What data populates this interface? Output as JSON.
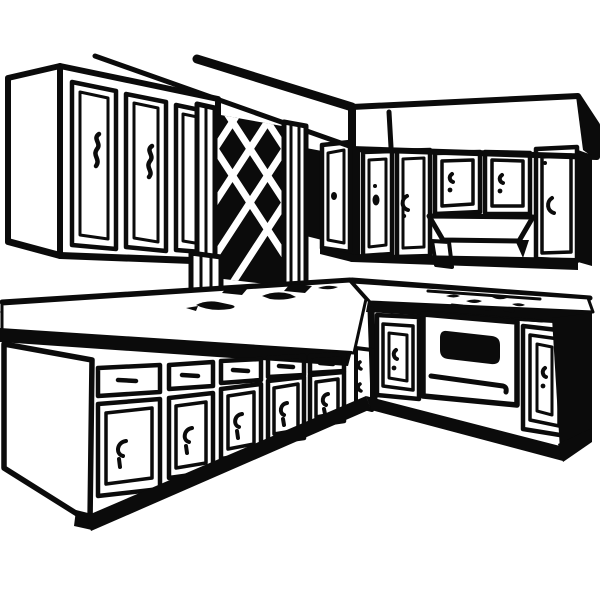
{
  "meta": {
    "title": "Retro kitchen clipart",
    "description": "Black-and-white vintage line-art clipart of an L-shaped kitchen: upper wall cabinets on the left, a dark lattice window between pillars, a soffit with upper cabinets and a range hood on the right wall, an L-shaped countertop with sink shadows and cooktop burner marks, base cabinets with drawers and panel doors, and an oven with a dark window on the right run."
  },
  "colors": {
    "ink": "#0b0b0b",
    "background": "#ffffff"
  },
  "scene": {
    "style": "vintage black ink illustration on white",
    "elements": [
      {
        "name": "ceiling-lines",
        "label": "Ceiling lines"
      },
      {
        "name": "upper-cabinets-left",
        "label": "Upper wall cabinets (left wall)",
        "door_count": 3
      },
      {
        "name": "lattice-window",
        "label": "Dark lattice window with crossed muntins"
      },
      {
        "name": "soffit-right",
        "label": "Soffit band (right wall)"
      },
      {
        "name": "upper-cabinets-right",
        "label": "Upper wall cabinets (right wall)",
        "door_count": 5
      },
      {
        "name": "range-hood",
        "label": "Range hood"
      },
      {
        "name": "countertop",
        "label": "L-shaped countertop with backsplash"
      },
      {
        "name": "sink-shadows",
        "label": "Sink / shadow blobs on counter"
      },
      {
        "name": "cooktop",
        "label": "Cooktop burner marks"
      },
      {
        "name": "oven",
        "label": "Oven with dark window and handle bar"
      },
      {
        "name": "base-cabinets-left",
        "label": "Base cabinets with drawers (left run)",
        "bay_count": 5
      },
      {
        "name": "base-cabinets-right",
        "label": "Base cabinets (right run)"
      },
      {
        "name": "toe-kick",
        "label": "Toe-kick shadow band"
      }
    ]
  }
}
